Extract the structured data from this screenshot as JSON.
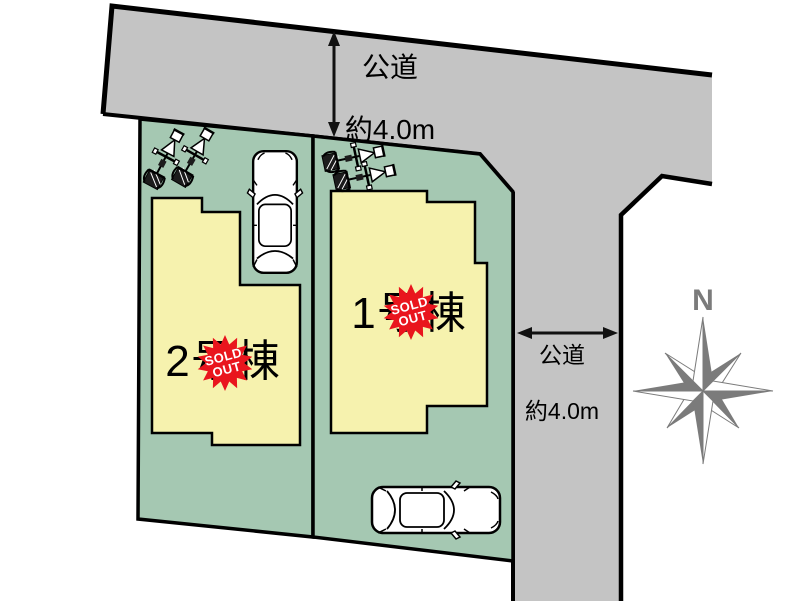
{
  "plan": {
    "roads": {
      "top": {
        "name_line": "公道",
        "width_line": "約4.0m"
      },
      "side": {
        "name_line": "公道",
        "width_line": "約4.0m"
      }
    },
    "buildings": [
      {
        "label": "1号棟",
        "badge": {
          "line1": "SOLD",
          "line2": "OUT"
        }
      },
      {
        "label": "2号棟",
        "badge": {
          "line1": "SOLD",
          "line2": "OUT"
        }
      }
    ],
    "compass": {
      "north_label": "N"
    },
    "colors": {
      "road_gray": "#c4c4c4",
      "parcel_green": "#a5c8b2",
      "building_yellow": "#f6f2ae",
      "badge_red": "#e9151d",
      "compass_gray": "#7b7b7b",
      "outline_black": "#000000"
    }
  }
}
